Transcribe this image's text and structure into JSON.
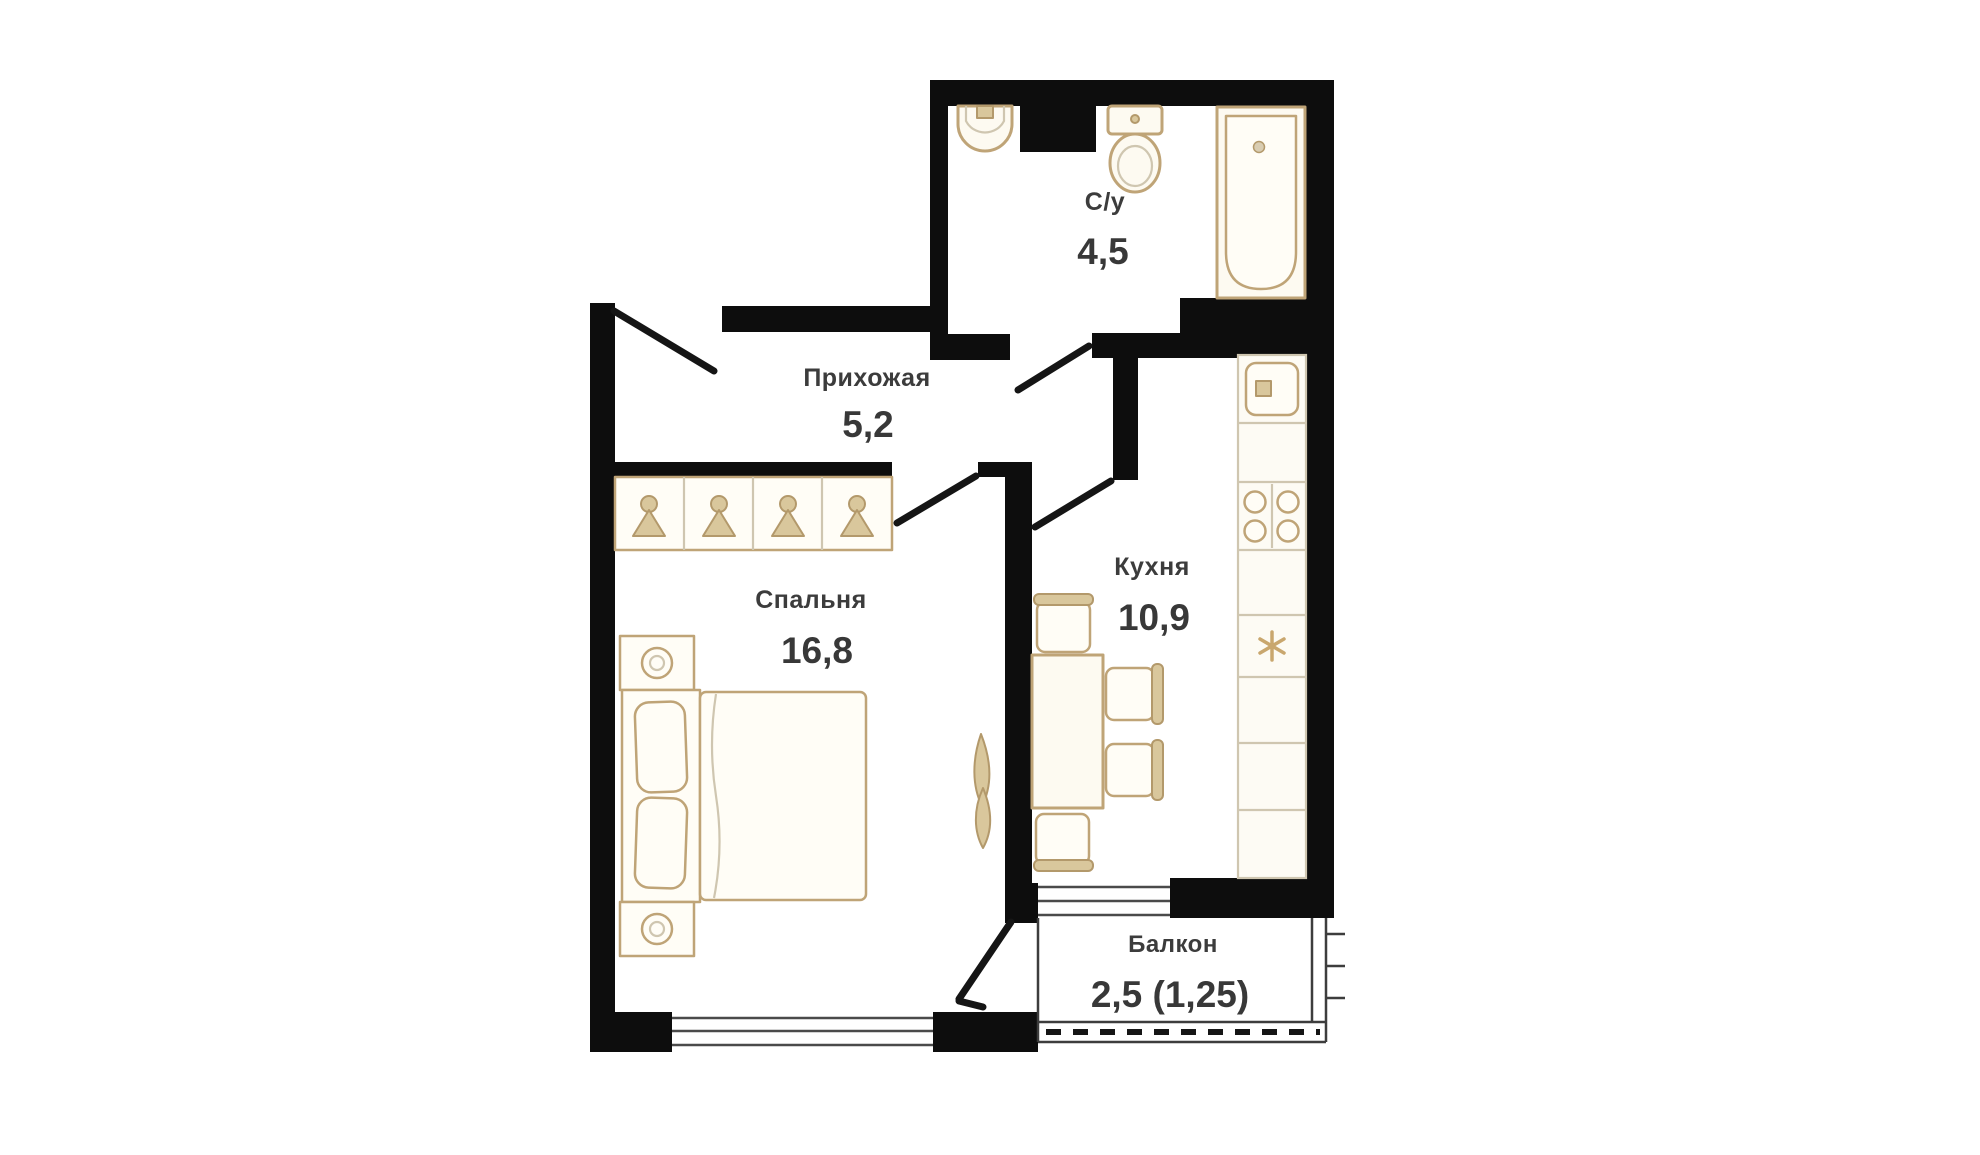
{
  "colors": {
    "wall": "#0d0d0d",
    "furniture_outline": "#bfa477",
    "furniture_fill": "#fdfaf1",
    "text": "#3c3c3c",
    "background": "#ffffff",
    "window_line": "#4a4a4a",
    "railing": "#3d3d3d"
  },
  "rooms": {
    "bathroom": {
      "label": "С/у",
      "area": "4,5"
    },
    "hallway": {
      "label": "Прихожая",
      "area": "5,2"
    },
    "bedroom": {
      "label": "Спальня",
      "area": "16,8"
    },
    "kitchen": {
      "label": "Кухня",
      "area": "10,9"
    },
    "balcony": {
      "label": "Балкон",
      "area": "2,5 (1,25)"
    }
  },
  "icons": {
    "bathroom": [
      "wash-basin-icon",
      "toilet-icon",
      "bathtub-icon"
    ],
    "hallway": [
      "entry-door-swing-icon",
      "wardrobe-hangers-icon"
    ],
    "bedroom": [
      "double-bed-icon",
      "nightstand-lamp-icon",
      "plant-icon",
      "window-icon",
      "balcony-door-swing-icon"
    ],
    "kitchen": [
      "counter-sink-icon",
      "stove-burners-icon",
      "fridge-snowflake-icon",
      "dining-table-icon",
      "chair-icon",
      "window-icon"
    ],
    "balcony": [
      "railing-hatch-icon"
    ]
  }
}
